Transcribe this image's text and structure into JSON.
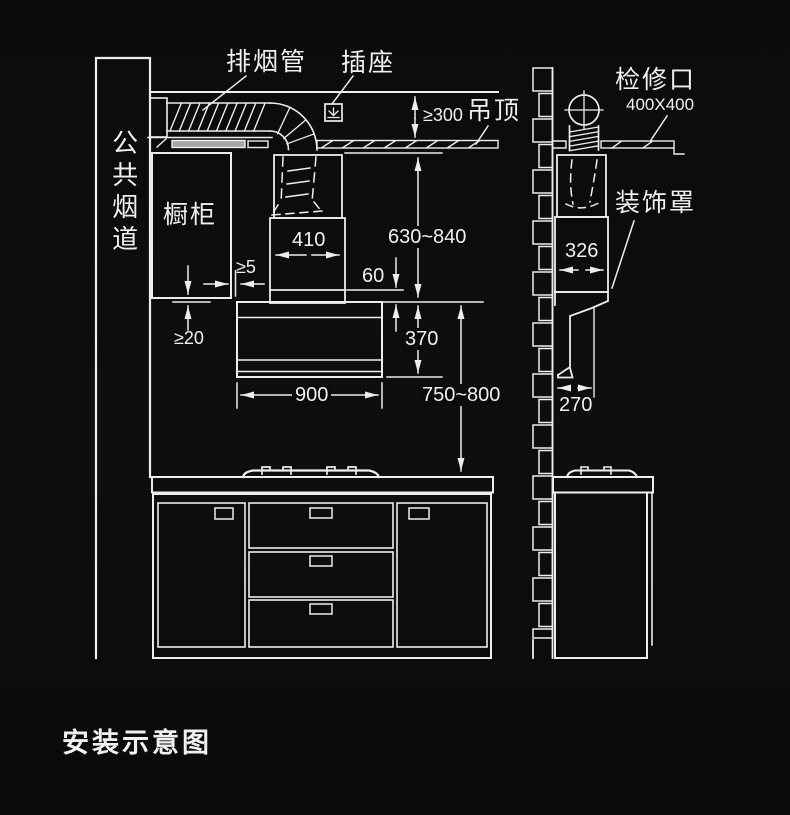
{
  "title": "安装示意图",
  "colors": {
    "background": "#0c0c0c",
    "line": "#ededed",
    "text": "#f0f0f0",
    "ceiling_section_fill": "#a6a6a6"
  },
  "labels": {
    "exhaust_pipe": "排烟管",
    "socket": "插座",
    "ceiling": "吊顶",
    "public_flue": "公共烟道",
    "wall_cabinet": "橱柜",
    "inspection_port": "检修口",
    "inspection_port_size": "400X400",
    "decorative_cover": "装饰罩"
  },
  "dimensions": {
    "ceiling_clearance": "≥300",
    "cover_width": "410",
    "hood_height_range": "630~840",
    "overlap": "60",
    "body_height": "370",
    "body_width": "900",
    "counter_height_range": "750~800",
    "cabinet_side_clearance": "≥5",
    "cabinet_bottom_clearance": "≥20",
    "side_cover_width": "326",
    "side_depth": "270"
  }
}
